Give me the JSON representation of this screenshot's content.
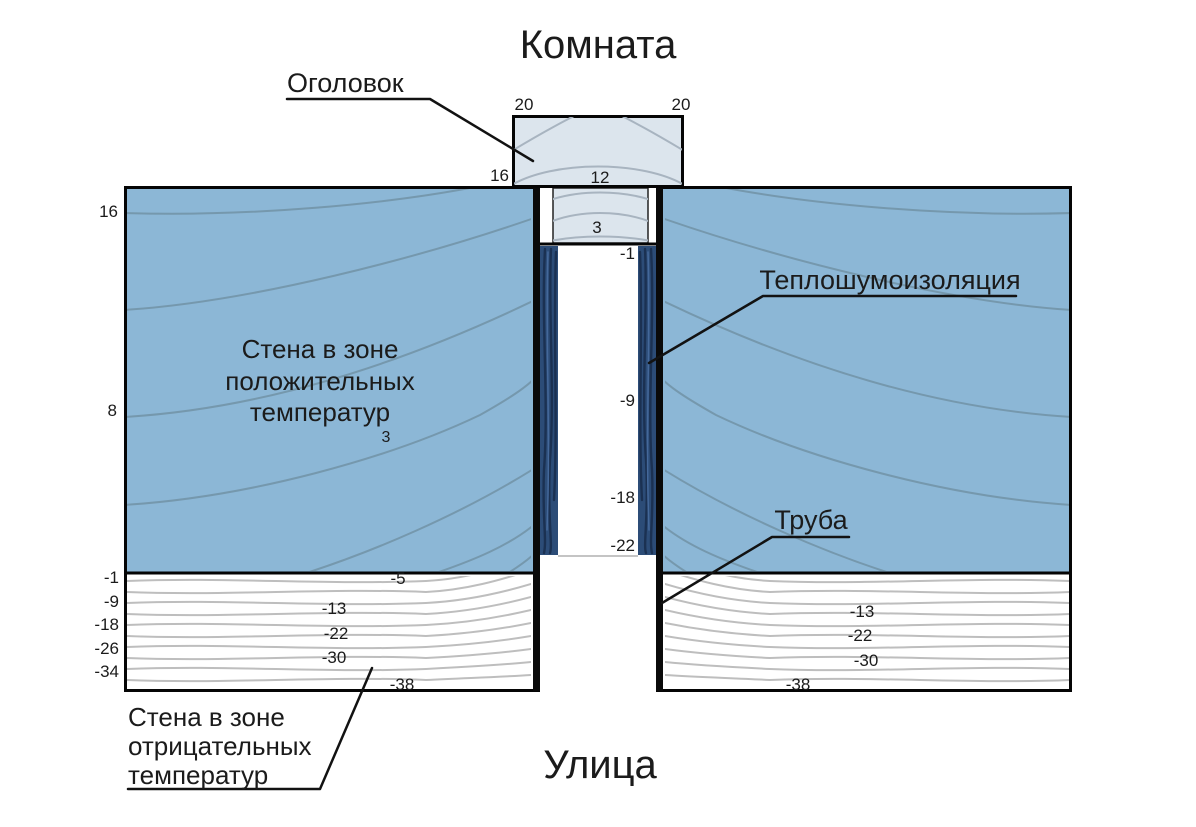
{
  "titles": {
    "room": "Комната",
    "street": "Улица"
  },
  "callouts": {
    "cap": "Оголовок",
    "insulation": "Теплошумоизоляция",
    "pipe": "Труба"
  },
  "zone_labels": {
    "positive": [
      "Стена в зоне",
      "положительных",
      "температур"
    ],
    "negative": [
      "Стена в зоне",
      "отрицательных",
      "температур"
    ]
  },
  "temps": {
    "cap_top_left": "20",
    "cap_top_right": "20",
    "cap_left": "16",
    "cap_mid": "12",
    "cap_inner": "3",
    "wall_outside_left": [
      "16",
      "8"
    ],
    "wall_inner": "3",
    "pipe_inner": [
      "-1",
      "-9",
      "-18",
      "-22"
    ],
    "neg_outside_left": [
      "-1",
      "-9",
      "-18",
      "-26",
      "-34"
    ],
    "neg_inside_left": [
      "-5",
      "-13",
      "-22",
      "-30",
      "-38"
    ],
    "neg_inside_right": [
      "-13",
      "-22",
      "-30",
      "-38"
    ]
  },
  "colors": {
    "wall_positive": "#8CB7D6",
    "wall_isoline": "#7496AB",
    "cap_fill": "#DCE5ED",
    "insulation": "#2C4C77",
    "negative_isoline": "#BEBEBE",
    "outline": "#050505",
    "text": "#1B1B1B"
  }
}
